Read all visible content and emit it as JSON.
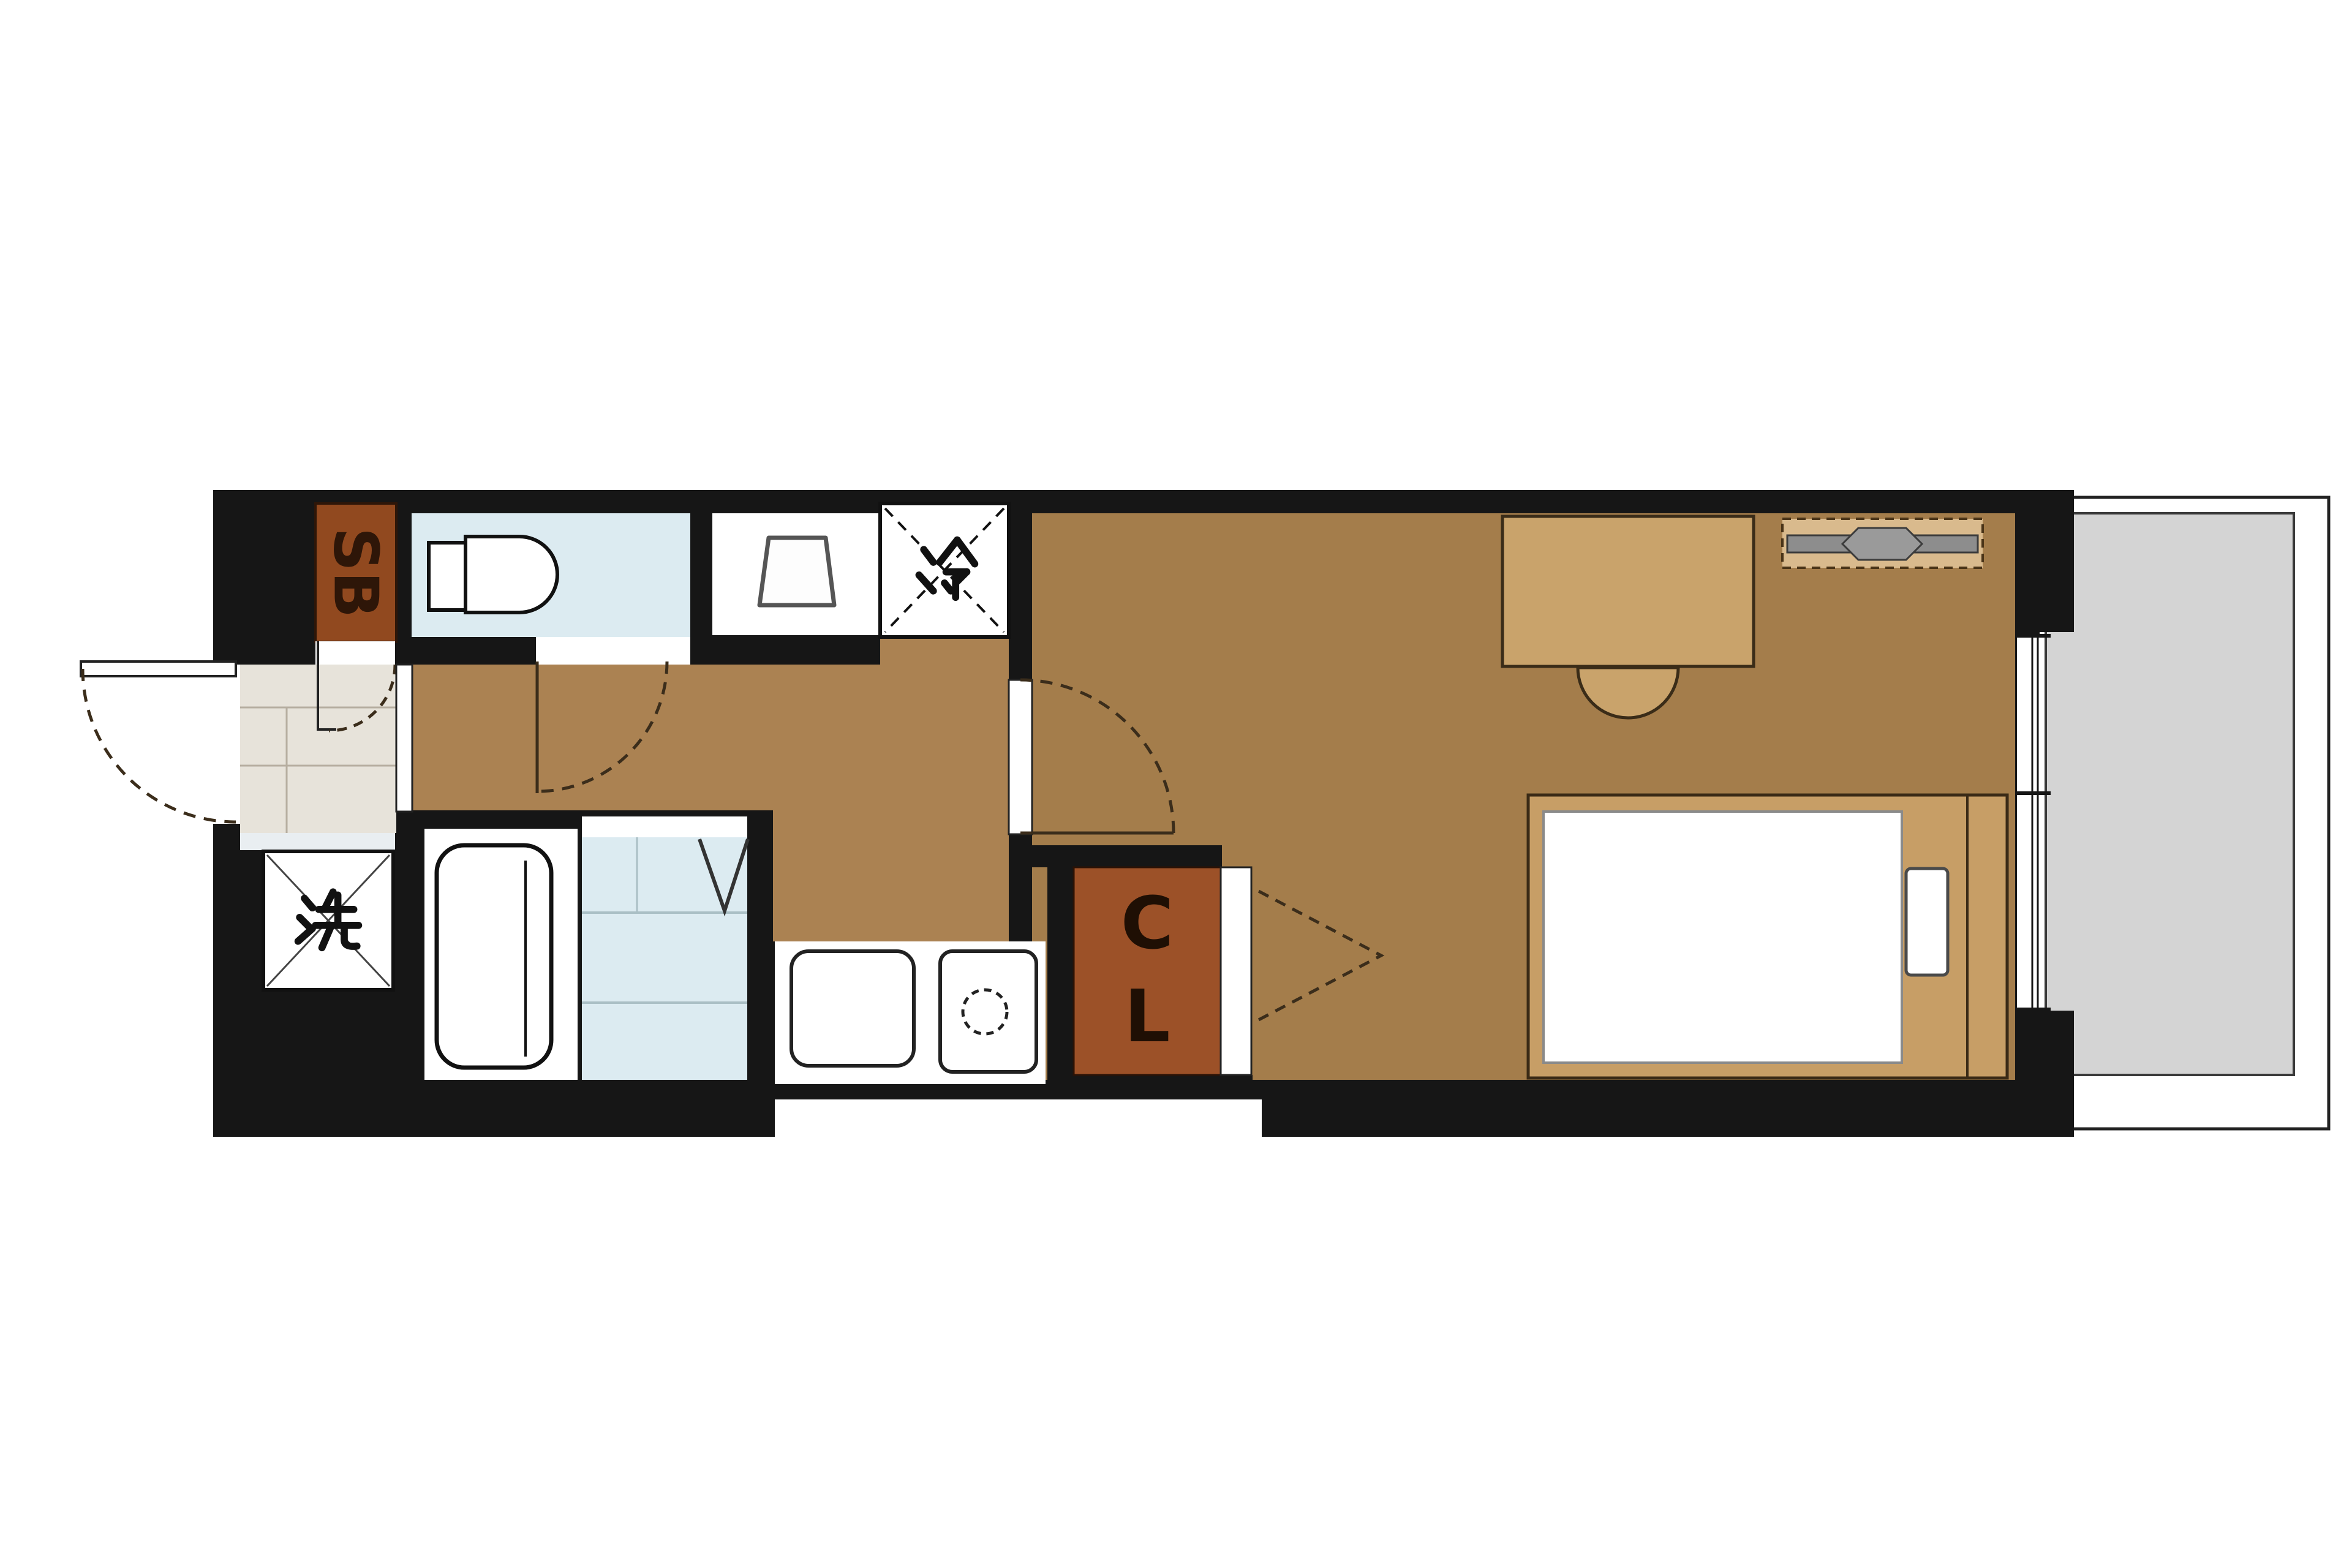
{
  "plan": {
    "type": "floorplan",
    "labels": {
      "shoe_box": "SB",
      "refrigerator": "冷",
      "washing_machine": "洗",
      "closet_letters": [
        "C",
        "L"
      ]
    },
    "colors": {
      "wall": "#161616",
      "main_floor": "#a47d4b",
      "corridor_floor": "#ab8252",
      "wet_area_floor": "#dcebf1",
      "entrance_tile": "#e7e3da",
      "balcony": "#d4d4d4",
      "shoe_box": "#91491f",
      "closet": "#9c5128",
      "furniture_tan": "#c9a36b",
      "bed_frame": "#c79e66",
      "tv_board": "#d9ba8d"
    }
  }
}
